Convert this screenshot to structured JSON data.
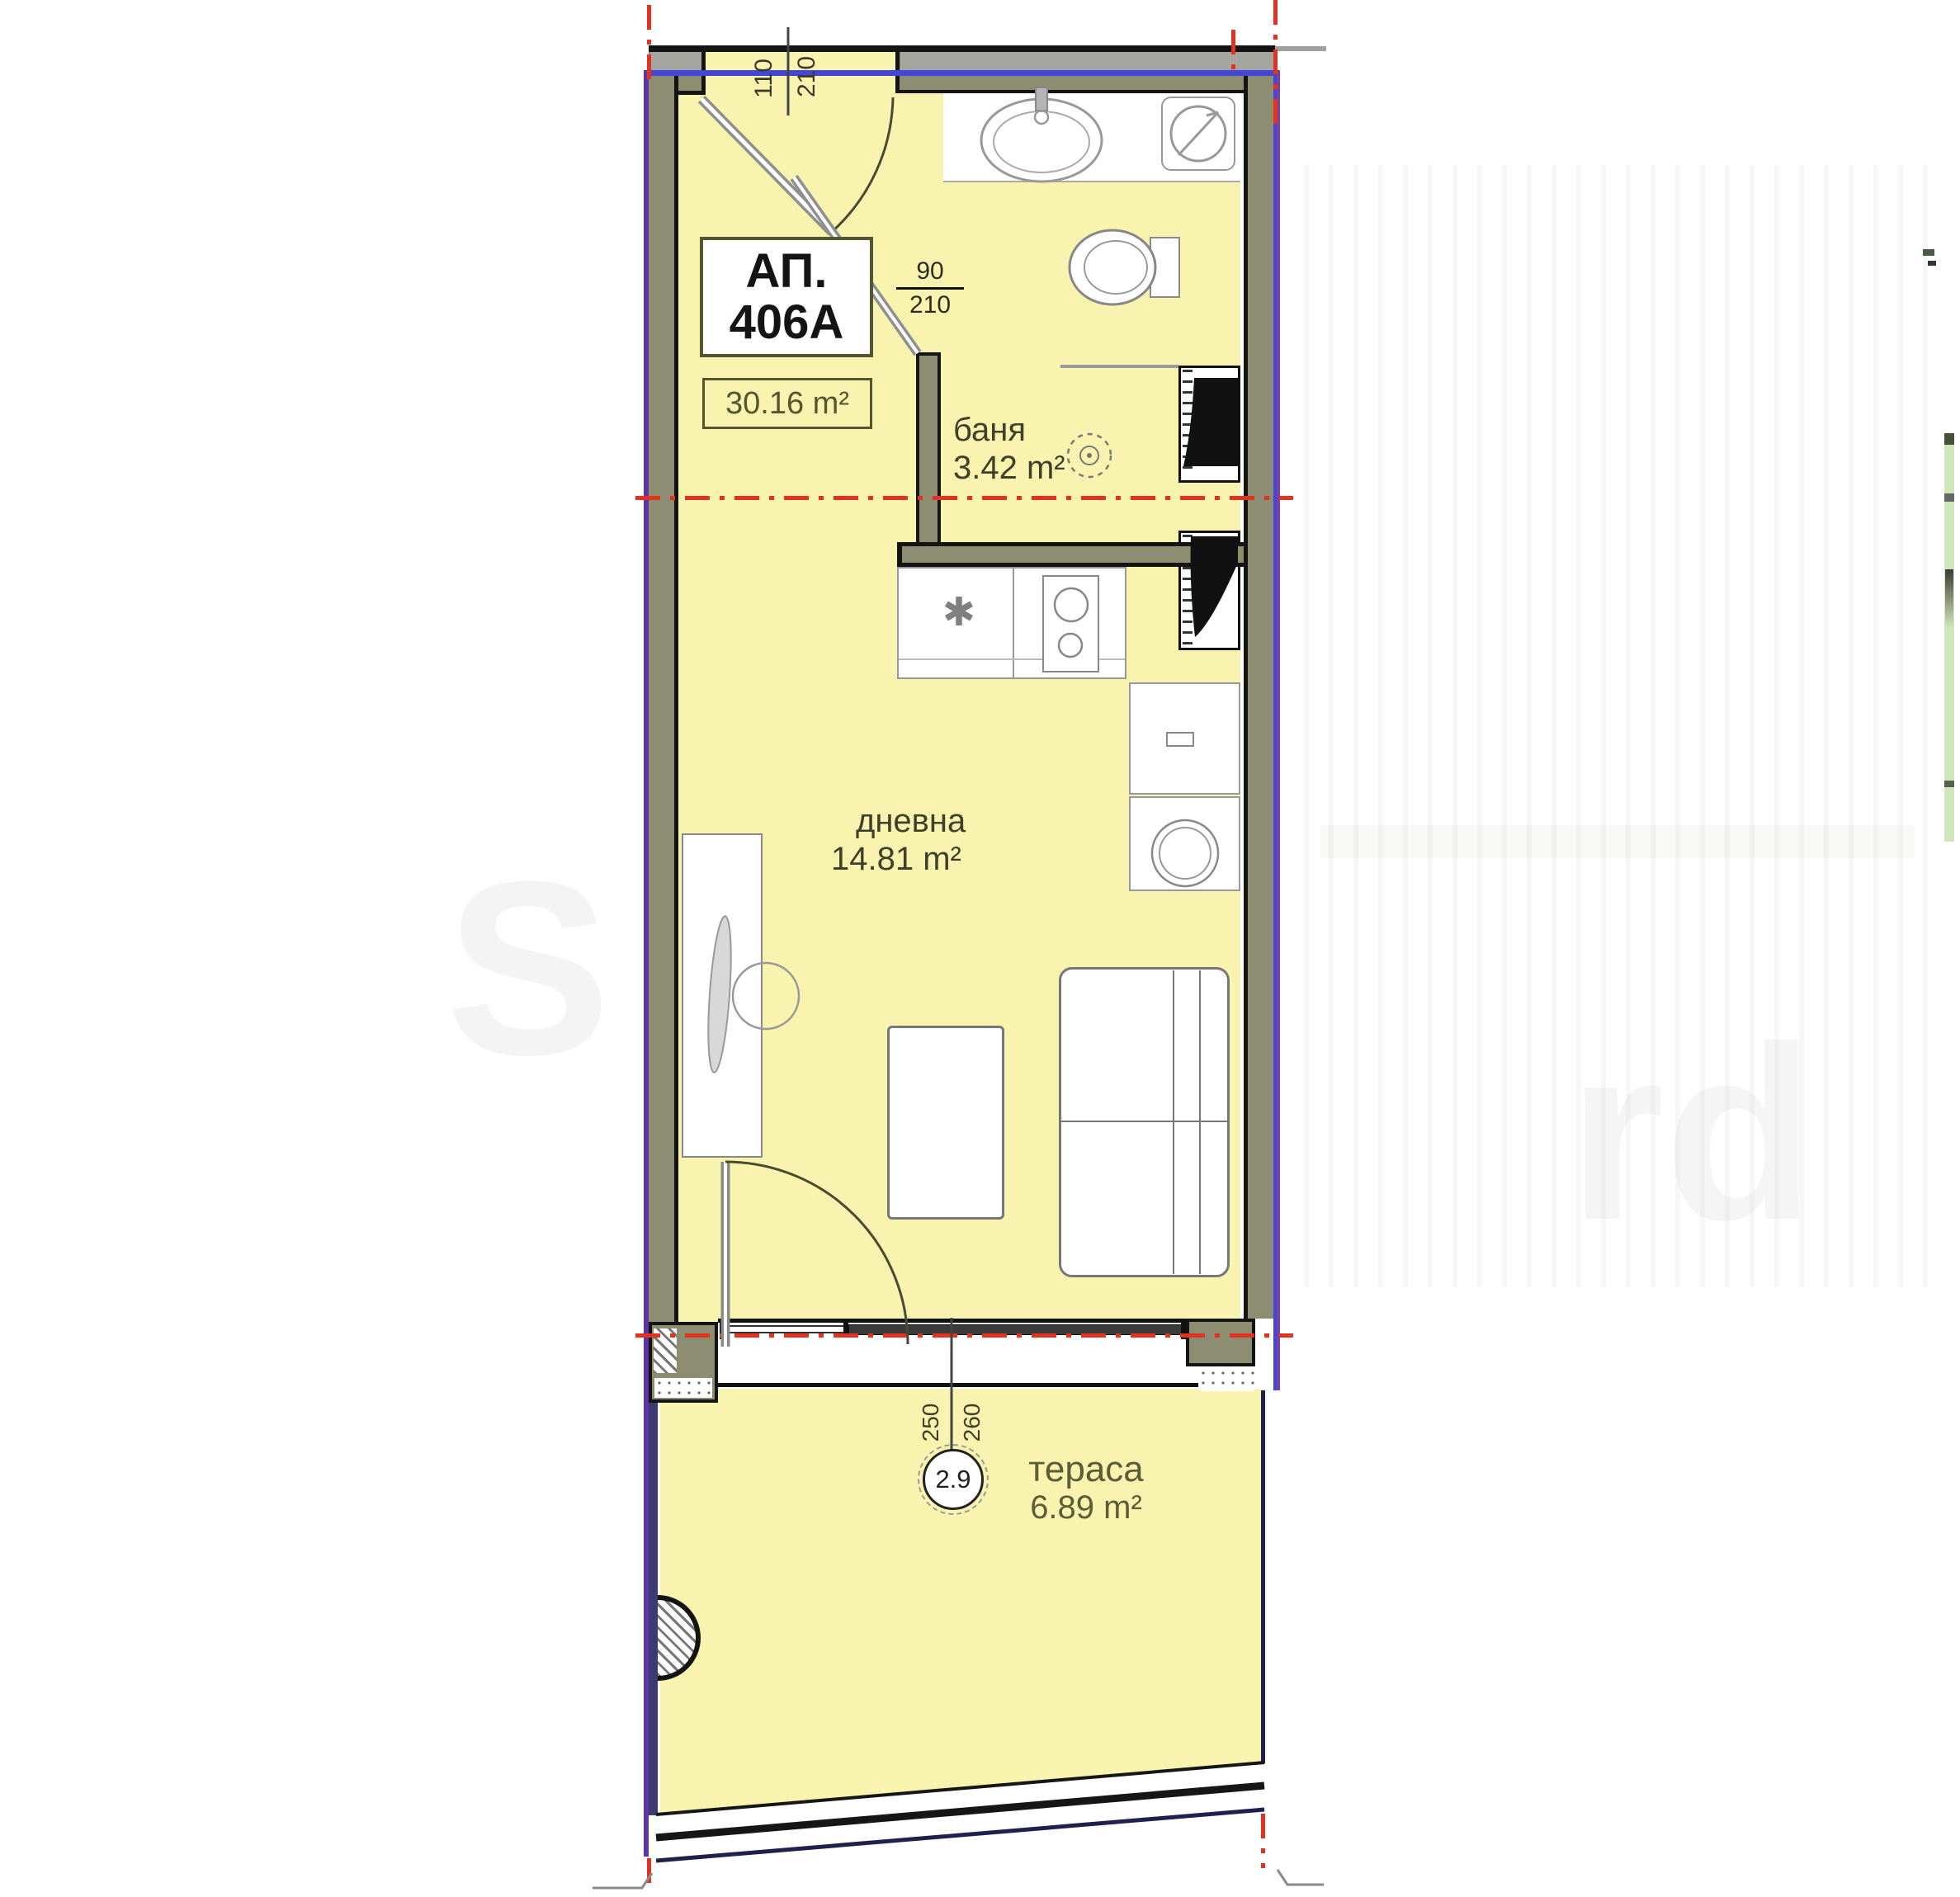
{
  "apartment": {
    "label_prefix": "АП.",
    "number": "406А",
    "total_area": "30.16 m²"
  },
  "rooms": [
    {
      "key": "bathroom",
      "name": "баня",
      "area": "3.42 m²"
    },
    {
      "key": "living",
      "name": "дневна",
      "area": "14.81 m²"
    },
    {
      "key": "terrace",
      "name": "тераса",
      "area": "6.89 m²"
    }
  ],
  "dimensions": {
    "entry_door": {
      "width": "110",
      "height": "210"
    },
    "bathroom_door": {
      "width": "90",
      "height": "210"
    },
    "terrace_door": {
      "width": "250",
      "height": "260"
    },
    "level_mark": "2.9"
  },
  "colors": {
    "room_fill": "#f8f3ae",
    "wall_olive": "#8d8d71",
    "outline_black": "#141414",
    "axis_blue": "#4646d6",
    "boundary_purple": "#5c35a8",
    "centerline_red": "#e23222",
    "railing_navy": "#20204e",
    "label_olive": "#3f3f2a"
  },
  "watermark": {
    "left_fragment": "S",
    "right_fragment": "rd"
  }
}
